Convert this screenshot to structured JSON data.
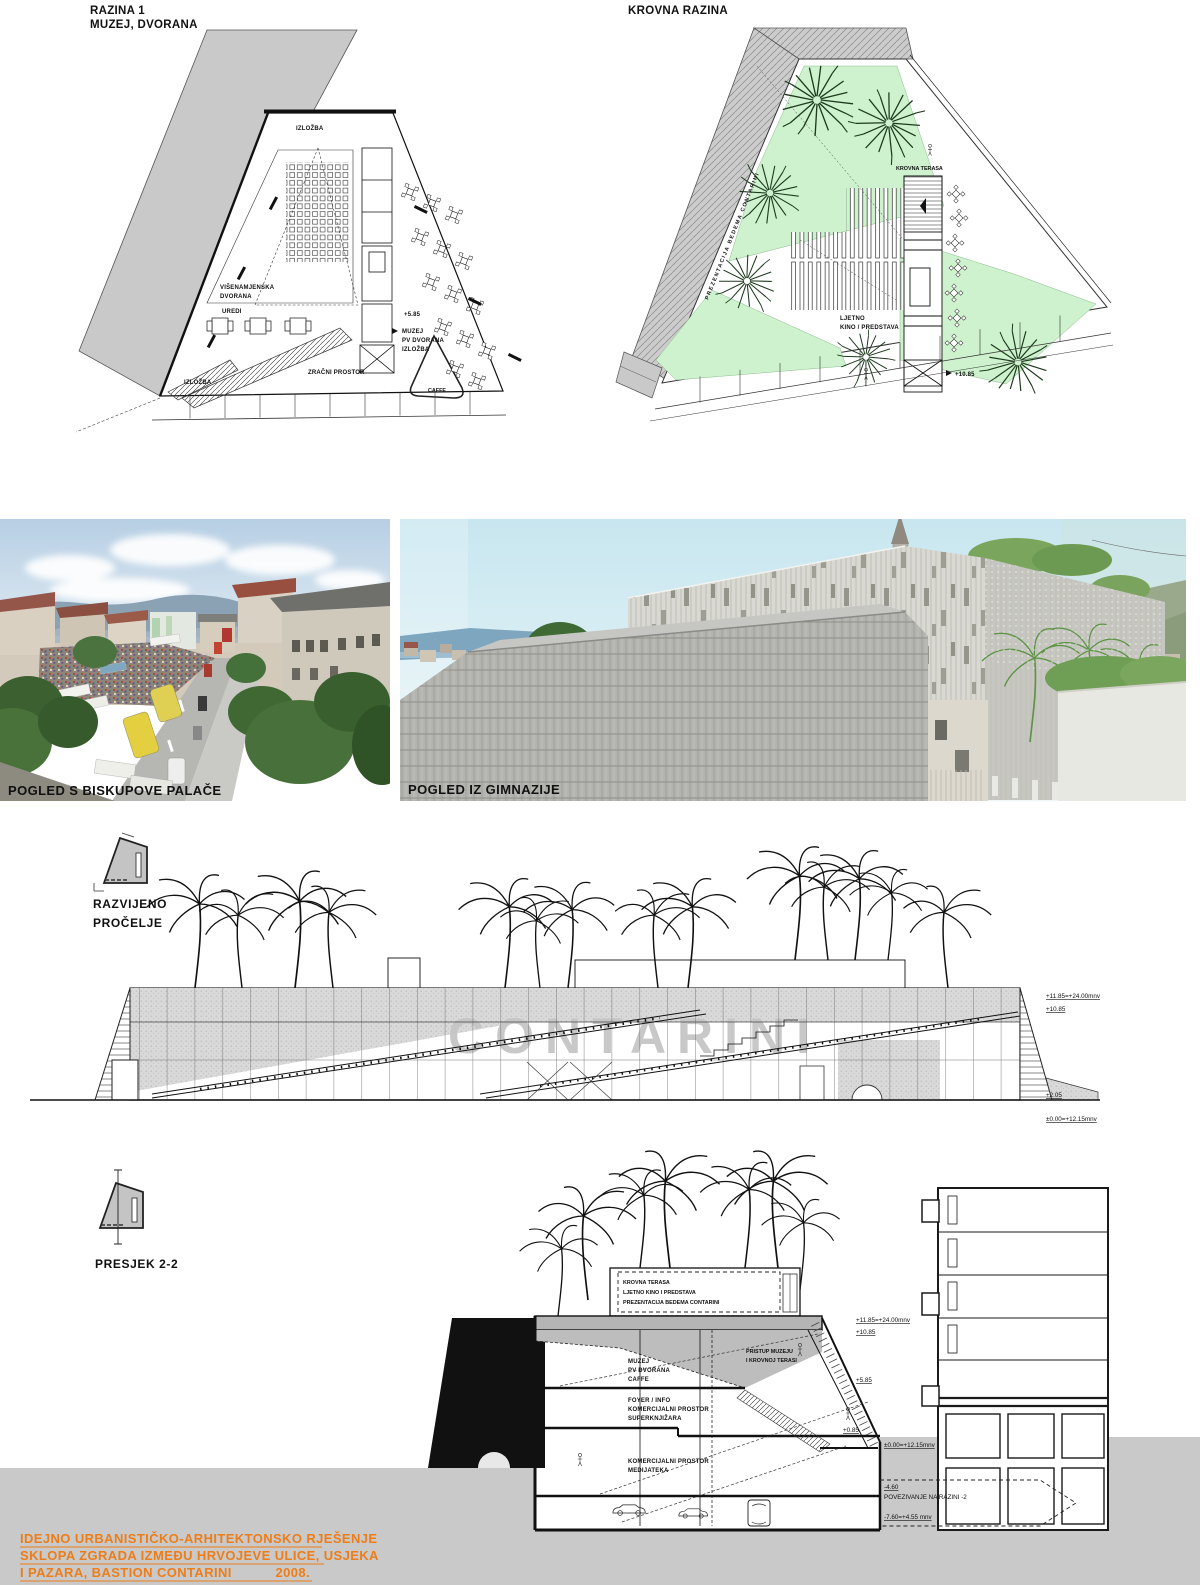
{
  "plan1": {
    "title1": "RAZINA 1",
    "title2": "MUZEJ, DVORANA",
    "izlozba_top": "IZLOŽBA",
    "hall1": "VIŠENAMJENSKA",
    "hall2": "DVORANA",
    "uredi": "UREDI",
    "level": "+5.85",
    "muzej1": "MUZEJ",
    "muzej2": "PV DVORANA",
    "muzej3": "IZLOŽBA",
    "zracni": "ZRAČNI PROSTOR",
    "izlozba_bottom": "IZLOŽBA",
    "caffe": "CAFFE"
  },
  "roof": {
    "title": "KROVNA RAZINA",
    "prezentacija": "PREZENTACIJA BEDEMA CONTARINI",
    "terasa": "KROVNA TERASA",
    "ljetno1": "LJETNO",
    "ljetno2": "KINO / PREDSTAVA",
    "level": "+10.85"
  },
  "photos": {
    "left_caption": "POGLED S BISKUPOVE PALAČE",
    "right_caption": "POGLED IZ GIMNAZIJE"
  },
  "elevation": {
    "label1": "RAZVIJENO",
    "label2": "PROČELJE",
    "watermark": "CONTARINI",
    "lvl_top": "+11.85=+24.00mnv",
    "lvl_roof": "+10.85",
    "lvl_street": "+2.05",
    "lvl_zero": "±0.00=+12.15mnv"
  },
  "section": {
    "label": "PRESJEK 2-2",
    "roofbox1": "KROVNA TERASA",
    "roofbox2": "LJETNO KINO I PREDSTAVA",
    "roofbox3": "PREZENTACIJA BEDEMA CONTARINI",
    "muzej1": "MUZEJ",
    "muzej2": "PV DVORANA",
    "muzej3": "CAFFE",
    "pristup1": "PRISTUP MUZEJU",
    "pristup2": "I KROVNOJ TERASI",
    "foyer1": "FOYER / INFO",
    "foyer2": "KOMERCIJALNI PROSTOR",
    "foyer3": "SUPERKNJIŽARA",
    "komerc1": "KOMERCIJALNI PROSTOR",
    "komerc2": "MEDIJATEKA",
    "lvl_top": "+11.85=+24.00mnv",
    "lvl_roof": "+10.85",
    "lvl_muzej": "+5.85",
    "lvl_ulaz": "+0.85",
    "lvl_zero": "±0.00=+12.15mnv",
    "lvl_m4": "-4.60",
    "povezivanje": "POVEZIVANJE NA RAZINI -2",
    "lvl_m7": "-7.60=+4.55 mnv"
  },
  "titleblock": {
    "line1": "IDEJNO URBANISTIČKO-ARHITEKTONSKO RJEŠENJE",
    "line2": "SKLOPA ZGRADA IZMEĐU HRVOJEVE ULICE, USJEKA",
    "line3": "I PAZARA, BASTION CONTARINI",
    "year": "2008.",
    "accent_color": "#ed7d18"
  }
}
